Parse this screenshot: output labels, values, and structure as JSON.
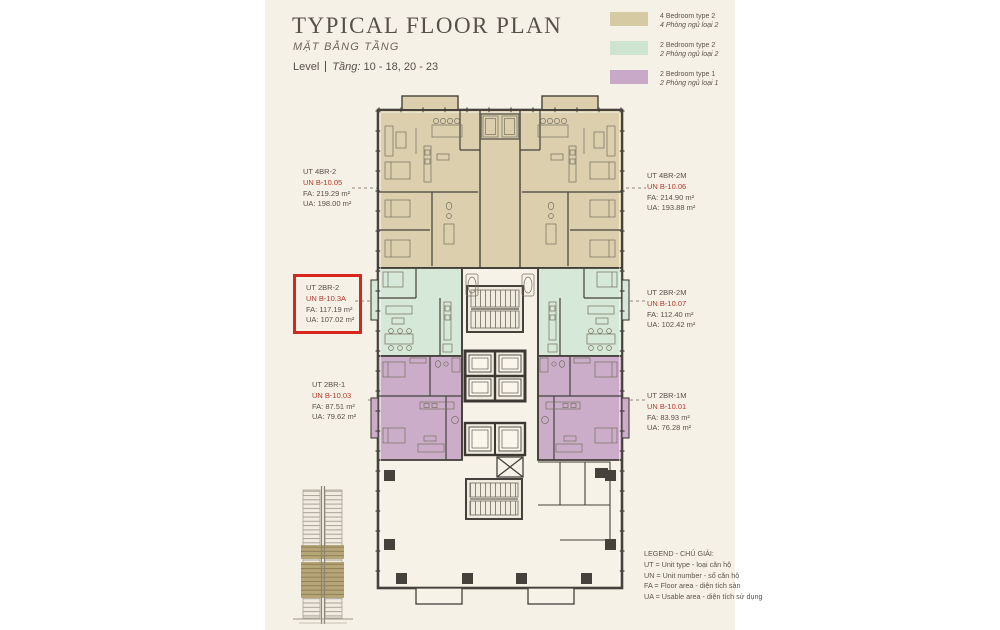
{
  "header": {
    "title": "TYPICAL FLOOR PLAN",
    "subtitle": "MẶT BẰNG TẦNG",
    "level_label": "Level",
    "level_prefix": "Tầng:",
    "level_range": "10 - 18, 20 - 23"
  },
  "legend": {
    "items": [
      {
        "name": "4-bedroom-type-2",
        "color": "#d6caa2",
        "line1": "4 Bedroom type 2",
        "line2": "4 Phòng ngủ loại 2"
      },
      {
        "name": "2-bedroom-type-2",
        "color": "#cfe3d1",
        "line1": "2 Bedroom type 2",
        "line2": "2 Phòng ngủ loại 2"
      },
      {
        "name": "2-bedroom-type-1",
        "color": "#c9a9c8",
        "line1": "2 Bedroom type 1",
        "line2": "2 Phòng ngủ loại 1"
      }
    ]
  },
  "units": [
    {
      "id": "B-10.05",
      "ut": "UT 4BR-2",
      "un": "UN B-10.05",
      "fa": "FA: 219.29 m²",
      "ua": "UA: 198.00 m²",
      "highlighted": false
    },
    {
      "id": "B-10.06",
      "ut": "UT 4BR-2M",
      "un": "UN B-10.06",
      "fa": "FA: 214.90 m²",
      "ua": "UA: 193.88 m²",
      "highlighted": false
    },
    {
      "id": "B-10.3A",
      "ut": "UT 2BR-2",
      "un": "UN B-10.3A",
      "fa": "FA: 117.19 m²",
      "ua": "UA: 107.02 m²",
      "highlighted": true
    },
    {
      "id": "B-10.07",
      "ut": "UT 2BR-2M",
      "un": "UN B-10.07",
      "fa": "FA: 112.40 m²",
      "ua": "UA: 102.42 m²",
      "highlighted": false
    },
    {
      "id": "B-10.03",
      "ut": "UT 2BR-1",
      "un": "UN B-10.03",
      "fa": "FA: 87.51 m²",
      "ua": "UA: 79.62 m²",
      "highlighted": false
    },
    {
      "id": "B-10.01",
      "ut": "UT 2BR-1M",
      "un": "UN B-10.01",
      "fa": "FA: 83.93 m²",
      "ua": "UA: 76.28 m²",
      "highlighted": false
    }
  ],
  "footer_legend": {
    "title": "LEGEND - CHÚ GIẢI:",
    "lines": [
      "UT = Unit type - loại căn hộ",
      "UN = Unit number - số căn hộ",
      "FA = Floor area - diện tích sàn",
      "UA = Usable area - diện tích sử dụng"
    ]
  },
  "colors": {
    "page_background": "#ffffff",
    "panel_background": "#f6f1e7",
    "highlight_border": "#d7271d",
    "unit_number_text": "#b5392c",
    "tan_unit": "#d9cdab",
    "green_unit": "#d5e7d6",
    "purple_unit": "#c9abc8",
    "wall": "#45413b"
  }
}
